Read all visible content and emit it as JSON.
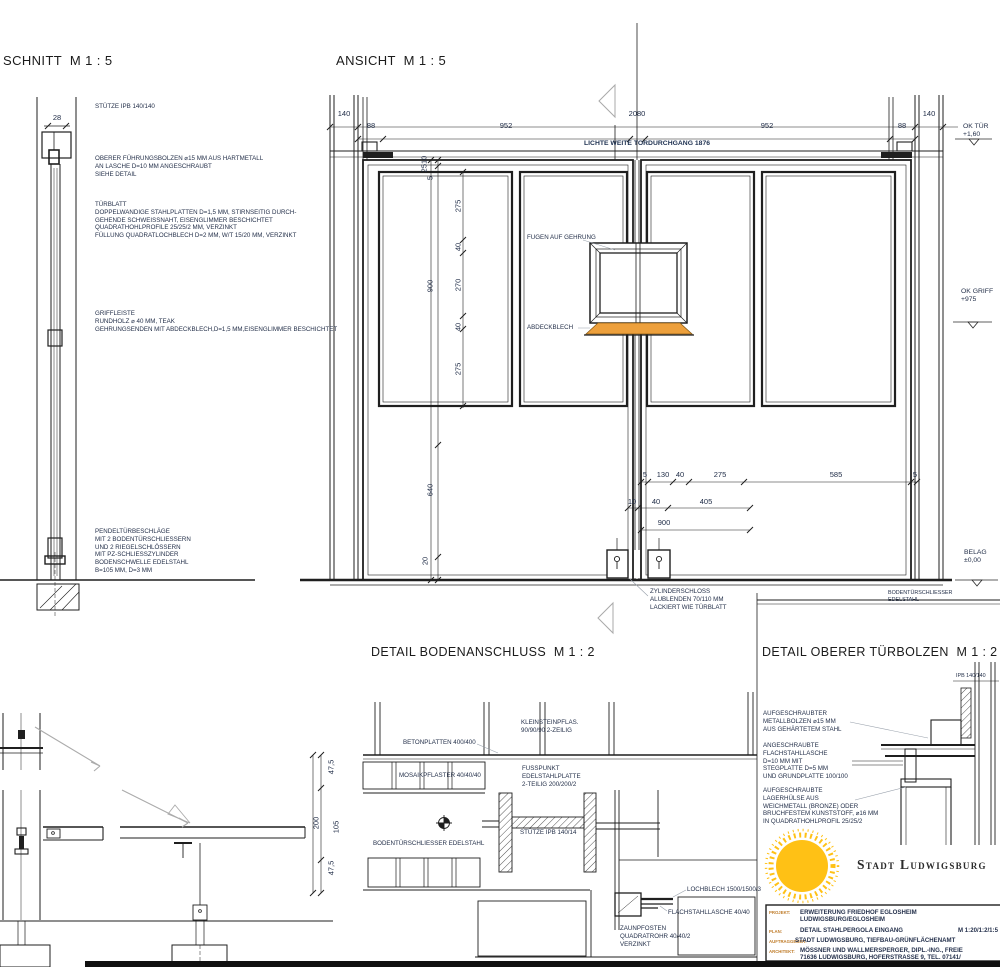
{
  "colors": {
    "line": "#1f1f1f",
    "annotation": "#24304a",
    "abdeckblech_orange": "#EDA03C",
    "sun_yellow": "#FFC115",
    "titleblock_label_orange": "#BF7C2A"
  },
  "titles": {
    "schnitt": "SCHNITT  M 1 : 5",
    "ansicht": "ANSICHT  M 1 : 5",
    "boden": "DETAIL BODENANSCHLUSS  M 1 : 2",
    "bolzen": "DETAIL OBERER TÜRBOLZEN  M 1 : 2"
  },
  "schnitt": {
    "stuetze": "STÜTZE IPB 140/140",
    "dim28": "28",
    "fuehrungsbolzen": "OBERER FÜHRUNGSBOLZEN ⌀15 MM AUS HARTMETALL\nAN LASCHE D=10 MM ANGESCHRAUBT\nSIEHE DETAIL",
    "tuerblatt": "TÜRBLATT\nDOPPELWANDIGE STAHLPLATTEN D=1,5 MM, STIRNSEITIG DURCH-\nGEHENDE SCHWEISSNAHT, EISENGLIMMER BESCHICHTET\nQUADRATHOHLPROFILE 25/25/2 MM, VERZINKT\nFÜLLUNG QUADRATLOCHBLECH D=2 MM, W/T 15/20 MM, VERZINKT",
    "griffleiste": "GRIFFLEISTE\nRUNDHOLZ ⌀ 40 MM, TEAK\nGEHRUNGSENDEN MIT ABDECKBLECH,D=1,5 MM,EISENGLIMMER BESCHICHTET",
    "pendeltuer": "PENDELTÜRBESCHLÄGE\nMIT 2 BODENTÜRSCHLIESSERN\nUND 2 RIEGELSCHLÖSSERN\nMIT PZ-SCHLIESSZYLINDER\nBODENSCHWELLE EDELSTAHL\nB=105 MM, D=3 MM"
  },
  "ansicht": {
    "lichte": "LICHTE WEITE TORDURCHGANG 1876",
    "fugen": "FUGEN AUF GEHRUNG",
    "abdeckblech": "ABDECKBLECH",
    "zylinderschloss": "ZYLINDERSCHLOSS\nALUBLENDEN 70/110 MM\nLACKIERT WIE TÜRBLATT",
    "ok_tuer": "OK TÜR\n+1,60",
    "ok_griff": "OK GRIFF\n+975",
    "belag": "BELAG\n±0,00",
    "bodenschliesser": "BODENTÜRSCHLIESSER\nEDELSTAHL",
    "dims": {
      "t140l": "140",
      "t88l": "88",
      "t952l": "952",
      "t2080": "2080",
      "t952r": "952",
      "t88r": "88",
      "t140r": "140",
      "v2510": "2510",
      "v5": "5",
      "v900": "900",
      "v640": "640",
      "v20": "20",
      "i275a": "275",
      "i40a": "40",
      "i270": "270",
      "i40b": "40",
      "i275b": "275",
      "b5a": "5",
      "b130": "130",
      "b40": "40",
      "b275": "275",
      "b585": "585",
      "b5b": "5",
      "c10": "10",
      "c40": "40",
      "c405": "405",
      "d900": "900"
    }
  },
  "boden": {
    "kleinstein": "KLEINSTEINPFLAS.\n90/90/90 2-ZEILIG",
    "betonplatten": "BETONPLATTEN 400/400",
    "mosaik": "MOSAIKPFLASTER 40/40/40",
    "fusspunkt": "FUSSPUNKT\nEDELSTAHLPLATTE\n2-TEILIG 200/200/2",
    "stuetze_ipb": "STÜTZE IPB 140/14",
    "bodenschliesser": "BODENTÜRSCHLIESSER EDELSTAHL",
    "lochblech": "LOCHBLECH 1500/1500/3",
    "flachstahl": "FLACHSTAHLLASCHE 40/40",
    "zaunpfosten": "ZAUNPFOSTEN\nQUADRATROHR 40/40/2\nVERZINKT",
    "dims": {
      "d47a": "47,5",
      "d105": "105",
      "d47b": "47,5",
      "d200": "200"
    }
  },
  "bolzen": {
    "ipb": "IPB 140/140",
    "metallbolzen": "AUFGESCHRAUBTER\nMETALLBOLZEN ⌀15 MM\nAUS GEHÄRTETEM STAHL",
    "lasche": "ANGESCHRAUBTE\nFLACHSTAHLLASCHE\nD=10 MM MIT\nSTEGPLATTE D=5 MM\nUND GRUNDPLATTE 100/100",
    "huelse": "AUFGESCHRAUBTE\nLAGERHÜLSE AUS\nWEICHMETALL (BRONZE) ODER\nBRUCHFESTEM KUNSTSTOFF, ⌀16 MM\nIN QUADRATHOHLPROFIL 25/25/2"
  },
  "titleblock": {
    "brand": "Stadt Ludwigsburg",
    "plan_scale": "M 1:20/1:2/1:5",
    "rows": [
      {
        "label": "PROJEKT:",
        "value": "ERWEITERUNG FRIEDHOF EGLOSHEIM\nLUDWIGSBURG/EGLOSHEIM"
      },
      {
        "label": "PLAN:",
        "value": "DETAIL STAHLPERGOLA EINGANG"
      },
      {
        "label": "AUFTRAGGEBER:",
        "value": "STADT LUDWIGSBURG, TIEFBAU-GRÜNFLÄCHENAMT"
      },
      {
        "label": "ARCHITEKT:",
        "value": "MÖSSNER UND WALLMERSPERGER, DIPL.-ING., FREIE\n71636 LUDWIGSBURG, HOFERSTRASSE 9, TEL. 07141/"
      }
    ]
  }
}
